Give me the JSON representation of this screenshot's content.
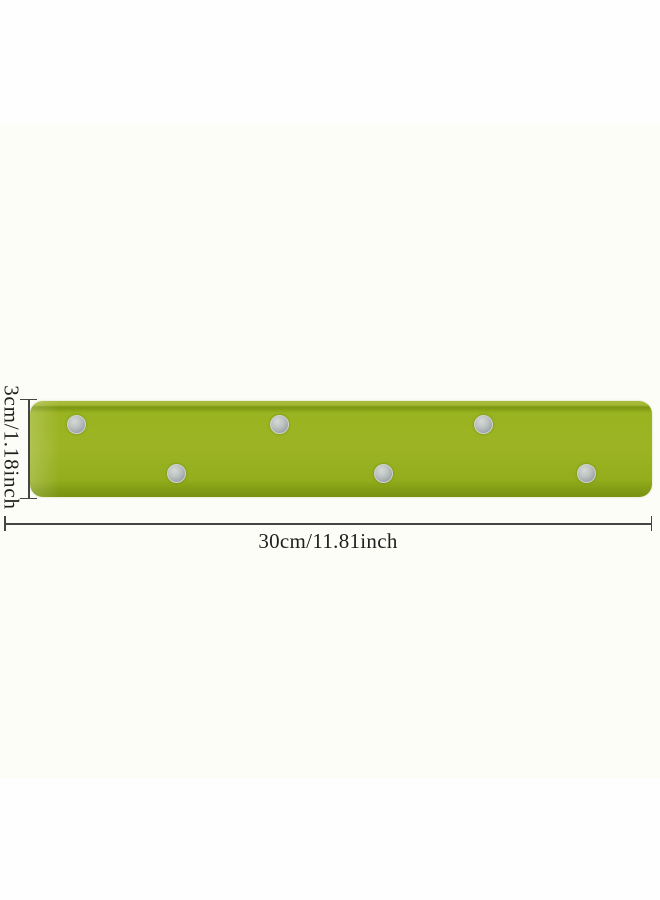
{
  "colors": {
    "background": "#fefefe",
    "backdrop": "#fbfbf2",
    "strip_green": "#9ab320",
    "strip_green_light": "#aabd3f",
    "strip_green_dark": "#7e9813",
    "dot_silver": "#a9b0b4",
    "dot_silver_light": "#d6d9d6",
    "dimension_line": "#454545",
    "label_text": "#1e1e1e"
  },
  "product": {
    "dot_count": 6,
    "dots": [
      {
        "x": 76,
        "y": 424
      },
      {
        "x": 176,
        "y": 473
      },
      {
        "x": 279,
        "y": 424
      },
      {
        "x": 383,
        "y": 473
      },
      {
        "x": 483,
        "y": 424
      },
      {
        "x": 586,
        "y": 473
      }
    ]
  },
  "annotations": {
    "height_label": "3cm/1.18inch",
    "width_label": "30cm/11.81inch"
  }
}
